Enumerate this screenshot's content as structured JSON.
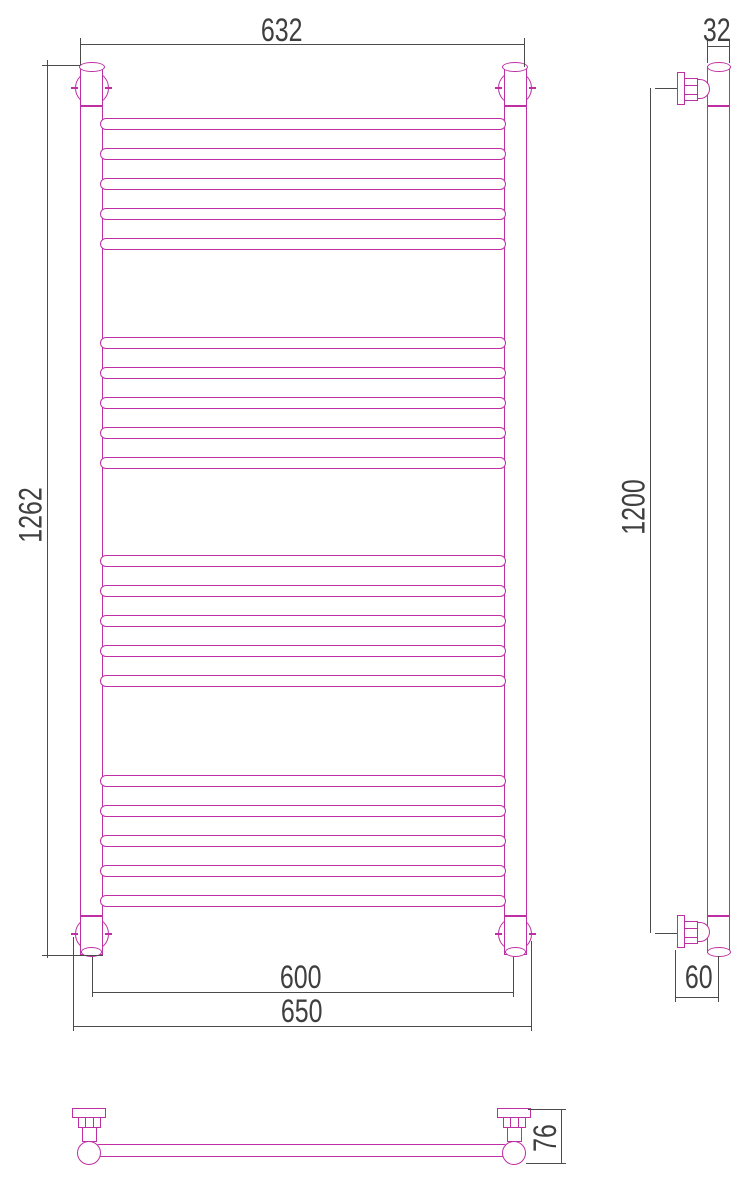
{
  "drawing": {
    "type": "technical-drawing",
    "subject": "ladder towel radiator, three orthographic views",
    "colors": {
      "part_line": "#BE2FA3",
      "dimension_line": "#4B4B4B",
      "text": "#3F3F3F",
      "background": "#FFFFFF"
    }
  },
  "views": {
    "front": {
      "dimensions": {
        "top_width": "632",
        "overall_height": "1262",
        "axis_spacing": "600",
        "overall_width": "650"
      },
      "rungs": {
        "groups": 4,
        "per_group": 5,
        "group_start_y": [
          118,
          337,
          555,
          775
        ],
        "pitch": 30,
        "height": 12,
        "x": 100,
        "width": 406
      }
    },
    "side": {
      "dimensions": {
        "tube_diameter": "32",
        "axis_height": "1200",
        "wall_offset": "60"
      }
    },
    "bottom": {
      "dimensions": {
        "bracket_depth": "76"
      }
    }
  }
}
